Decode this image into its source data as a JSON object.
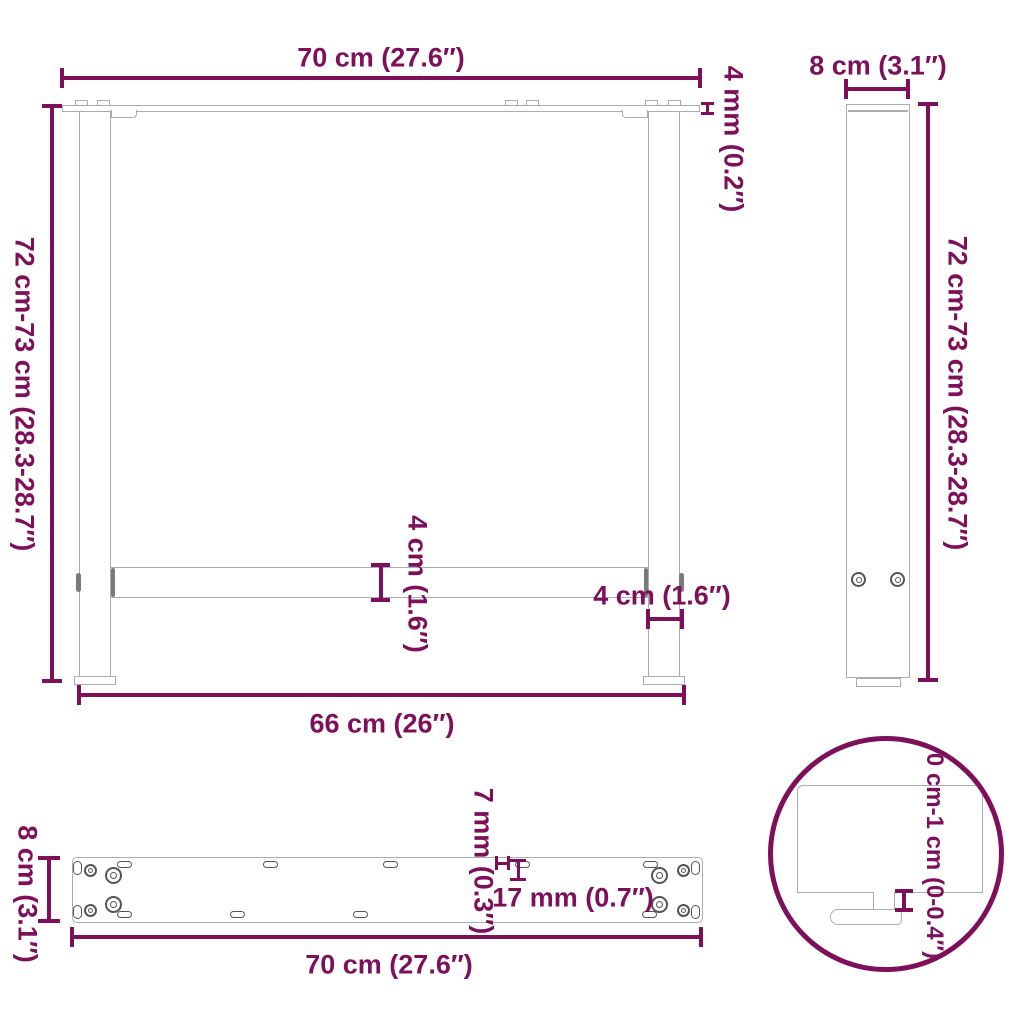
{
  "front": {
    "top_width": "70 cm (27.6″)",
    "plate_thickness": "4 mm (0.2″)",
    "height": "72 cm-73 cm (28.3-28.7″)",
    "crossbar_height": "4 cm (1.6″)",
    "leg_width": "4 cm (1.6″)",
    "bottom_width": "66 cm (26″)"
  },
  "side": {
    "width": "8 cm (3.1″)",
    "height": "72 cm-73 cm (28.3-28.7″)"
  },
  "top": {
    "depth": "8 cm (3.1″)",
    "hole_width": "7 mm (0.3″)",
    "hole_length": "17 mm (0.7″)",
    "width": "70 cm (27.6″)"
  },
  "detail": {
    "adjustable_range": "0 cm-1 cm (0-0.4″)"
  },
  "colors": {
    "dimension": "#7E0F5A",
    "outline": "#ACACAC",
    "detail": "#555555"
  }
}
